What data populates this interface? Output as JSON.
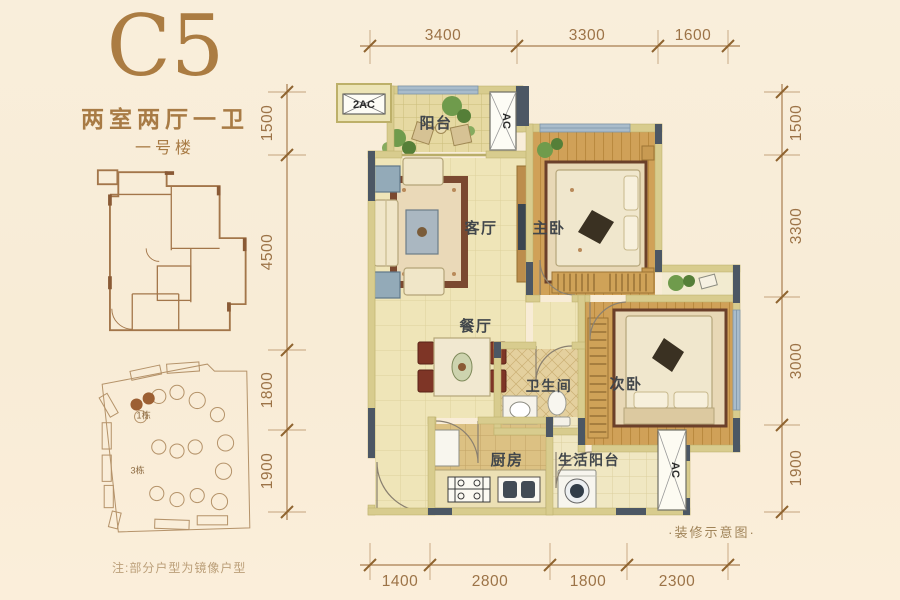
{
  "colors": {
    "background": "#f9edda",
    "accent_brown": "#ab7c42",
    "dimension_text": "#9c7347",
    "wall_khaki": "#d8cc8e",
    "wall_dark": "#4c5764",
    "wood_floor": "#d0a158",
    "tile_cream": "#efe5b8",
    "window_blue": "#a9bccb",
    "room_label": "#41464b"
  },
  "header": {
    "unit_code": "C5",
    "layout_type": "两室两厅一卫",
    "building": "一号楼"
  },
  "site_plan": {
    "building_1": "1栋",
    "building_3": "3栋"
  },
  "plan": {
    "rooms": {
      "balcony": "阳台",
      "living": "客厅",
      "master_bedroom": "主卧",
      "dining": "餐厅",
      "bathroom": "卫生间",
      "second_bedroom": "次卧",
      "kitchen": "厨房",
      "utility_balcony": "生活阳台"
    },
    "ac": {
      "balcony_platform": "2AC",
      "balcony_unit": "AC",
      "utility_unit": "AC"
    }
  },
  "dimensions": {
    "top": [
      "3400",
      "3300",
      "1600"
    ],
    "bottom": [
      "1400",
      "2800",
      "1800",
      "2300"
    ],
    "left": [
      "1500",
      "4500",
      "1800",
      "1900"
    ],
    "right": [
      "1500",
      "3300",
      "3000",
      "1900"
    ]
  },
  "footer": {
    "note": "注:部分户型为镜像户型",
    "caption": "·装修示意图·"
  }
}
